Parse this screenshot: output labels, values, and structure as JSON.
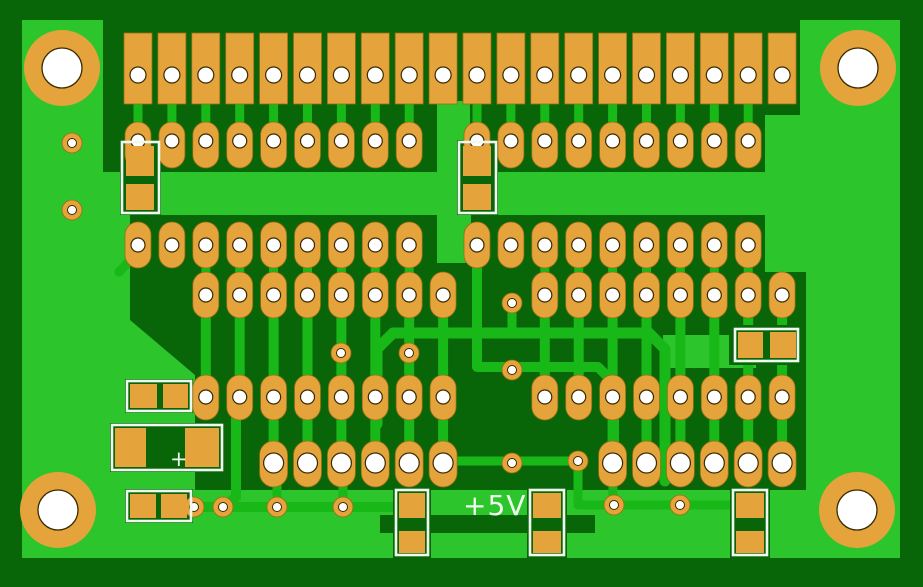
{
  "app": {
    "title": "PCB copper layer view"
  },
  "labels": {
    "voltage": {
      "text": "+5V",
      "x": 463,
      "y": 492,
      "size": 28
    },
    "cap_polarity": {
      "text": "+",
      "x": 170,
      "y": 449,
      "size": 21
    }
  },
  "colors": {
    "margin_dark": "#086609",
    "copper_pour": "#2cc52c",
    "trace": "#18b818",
    "pad": "#e4a33b",
    "pad_edge": "#9c6d12",
    "hole": "#ffffff",
    "hole_edge": "#3a2a00",
    "silkscreen": "#f0f9ef"
  },
  "pcb": {
    "canvas": {
      "w": 923,
      "h": 587
    },
    "board": {
      "x": 22,
      "y": 20,
      "w": 878,
      "h": 538
    },
    "grid": {
      "x0": 138,
      "pitch": 33.9
    },
    "etched_regions": [
      {
        "type": "rect",
        "x": 103,
        "y": 20,
        "w": 697,
        "h": 95
      },
      {
        "type": "rect",
        "x": 103,
        "y": 115,
        "w": 662,
        "h": 57
      },
      {
        "type": "poly",
        "pts": [
          [
            130,
            215
          ],
          [
            765,
            215
          ],
          [
            765,
            490
          ],
          [
            195,
            490
          ],
          [
            195,
            375
          ],
          [
            130,
            320
          ]
        ]
      },
      {
        "type": "rect",
        "x": 764,
        "y": 272,
        "w": 42,
        "h": 218
      }
    ],
    "copper_channels": [
      {
        "x": 437,
        "y": 101,
        "w": 33,
        "h": 71
      },
      {
        "x": 437,
        "y": 215,
        "w": 34,
        "h": 48
      },
      {
        "x": 663,
        "y": 335,
        "w": 93,
        "h": 33
      }
    ],
    "stub_groups": [
      {
        "cols": [
          0,
          1,
          2,
          3,
          4,
          5,
          6,
          7,
          8,
          10,
          11,
          12,
          13,
          14,
          15,
          16,
          17,
          18
        ],
        "y": 99,
        "h": 27,
        "w": 9
      },
      {
        "cols": [
          2,
          3,
          4,
          5,
          6,
          7,
          8,
          12,
          13,
          14,
          15,
          16,
          17,
          18
        ],
        "y": 262,
        "h": 14,
        "w": 9
      },
      {
        "cols": [
          2,
          3,
          4,
          5,
          6,
          7,
          8,
          9,
          12,
          13,
          14,
          15,
          16,
          17,
          18,
          19
        ],
        "y": 314,
        "h": 64,
        "w": 10
      },
      {
        "cols": [
          4,
          5,
          6,
          7,
          8,
          9,
          14,
          15,
          16,
          17,
          18,
          19
        ],
        "y": 416,
        "h": 28,
        "w": 10
      }
    ],
    "traces": [
      {
        "d": "M 377 424 L 377 349 L 393 333 L 649 333 L 665 349 L 665 481",
        "w": 11
      },
      {
        "d": "M 477 258 L 477 367 L 598 367 L 614 383 L 614 446",
        "w": 10
      },
      {
        "d": "M 613 483 L 613 503",
        "w": 9
      },
      {
        "d": "M 512 305 L 512 333",
        "w": 9
      },
      {
        "d": "M 434 461 L 575 461",
        "w": 9
      },
      {
        "d": "M 578 463 L 578 505 L 733 505",
        "w": 9
      },
      {
        "d": "M 194 507 L 397 507",
        "w": 10
      },
      {
        "d": "M 140 250 L 119 272",
        "w": 9
      },
      {
        "d": "M 236 418 L 236 497 L 226 505",
        "w": 10
      },
      {
        "d": "M 277 480 L 277 503",
        "w": 9
      },
      {
        "d": "M 343 480 L 343 503",
        "w": 9
      }
    ],
    "overlay_dark": [
      {
        "x": 380,
        "y": 515,
        "w": 215,
        "h": 18
      }
    ],
    "pad_rows": [
      {
        "name": "connector-row-1",
        "shape": "rect",
        "cols": [
          0,
          1,
          2,
          3,
          4,
          5,
          6,
          7,
          8,
          9,
          10,
          11,
          12,
          13,
          14,
          15,
          16,
          17,
          18,
          19
        ],
        "y": 33,
        "h": 71,
        "w": 28,
        "holeY": 75,
        "holeR": 8
      },
      {
        "name": "header-row-2",
        "shape": "stadium",
        "cols": [
          0,
          1,
          2,
          3,
          4,
          5,
          6,
          7,
          8,
          10,
          11,
          12,
          13,
          14,
          15,
          16,
          17,
          18
        ],
        "y": 122,
        "h": 46,
        "w": 26,
        "holeY": 141,
        "holeR": 7
      },
      {
        "name": "header-row-3",
        "shape": "stadium",
        "cols": [
          0,
          1,
          2,
          3,
          4,
          5,
          6,
          7,
          8,
          10,
          11,
          12,
          13,
          14,
          15,
          16,
          17,
          18
        ],
        "y": 222,
        "h": 46,
        "w": 26,
        "holeY": 245,
        "holeR": 7
      },
      {
        "name": "header-row-4",
        "shape": "stadium",
        "cols": [
          2,
          3,
          4,
          5,
          6,
          7,
          8,
          9,
          12,
          13,
          14,
          15,
          16,
          17,
          18,
          19
        ],
        "y": 272,
        "h": 46,
        "w": 26,
        "holeY": 295,
        "holeR": 7
      },
      {
        "name": "header-row-5",
        "shape": "stadium",
        "cols": [
          2,
          3,
          4,
          5,
          6,
          7,
          8,
          9,
          12,
          13,
          14,
          15,
          16,
          17,
          18,
          19
        ],
        "y": 375,
        "h": 45,
        "w": 26,
        "holeY": 397,
        "holeR": 7
      },
      {
        "name": "power-row-6",
        "shape": "stadium",
        "cols": [
          4,
          5,
          6,
          7,
          8,
          9,
          14,
          15,
          16,
          17,
          18,
          19
        ],
        "y": 441,
        "h": 46,
        "w": 28,
        "holeY": 463,
        "holeR": 10
      }
    ],
    "via_pads": {
      "r": 10,
      "holeR": 4.5,
      "points": [
        [
          72,
          143
        ],
        [
          72,
          210
        ],
        [
          341,
          353
        ],
        [
          409,
          353
        ],
        [
          512,
          303
        ],
        [
          512,
          370
        ],
        [
          512,
          463
        ],
        [
          578,
          461
        ],
        [
          614,
          505
        ],
        [
          680,
          505
        ],
        [
          194,
          507
        ],
        [
          223,
          507
        ],
        [
          277,
          507
        ],
        [
          343,
          507
        ]
      ]
    },
    "mounting_holes": {
      "rOuter": 38,
      "rHole": 20,
      "points": [
        [
          62,
          68
        ],
        [
          858,
          68
        ],
        [
          58,
          510
        ],
        [
          857,
          510
        ]
      ]
    },
    "smd_components": [
      {
        "name": "smd-resistor-vertical-left",
        "outline": [
          122,
          142,
          37,
          71
        ],
        "dark": [
          120,
          140,
          41,
          75
        ],
        "pads": [
          [
            126,
            146,
            28,
            30
          ],
          [
            126,
            184,
            28,
            26
          ]
        ]
      },
      {
        "name": "smd-resistor-vertical-mid",
        "outline": [
          459,
          142,
          37,
          71
        ],
        "dark": [
          457,
          140,
          41,
          75
        ],
        "pads": [
          [
            463,
            146,
            28,
            30
          ],
          [
            463,
            184,
            28,
            26
          ]
        ]
      },
      {
        "name": "smd-resistor-horizontal-left",
        "outline": [
          127,
          381,
          64,
          30
        ],
        "dark": [
          125,
          379,
          68,
          34
        ],
        "pads": [
          [
            130,
            384,
            27,
            24
          ],
          [
            163,
            384,
            25,
            24
          ]
        ]
      },
      {
        "name": "smd-capacitor-polarized",
        "outline": [
          112,
          425,
          110,
          45
        ],
        "dark": [
          110,
          423,
          114,
          49
        ],
        "pads": [
          [
            115,
            428,
            31,
            39
          ],
          [
            185,
            428,
            34,
            39
          ]
        ]
      },
      {
        "name": "smd-resistor-lower-left",
        "outline": [
          127,
          491,
          64,
          30
        ],
        "dark": [
          125,
          489,
          68,
          34
        ],
        "pads": [
          [
            130,
            494,
            26,
            24
          ],
          [
            161,
            494,
            26,
            24
          ]
        ]
      },
      {
        "name": "smd-resistor-right",
        "outline": [
          735,
          329,
          63,
          32
        ],
        "dark": [
          729,
          325,
          75,
          40
        ],
        "pads": [
          [
            738,
            332,
            25,
            26
          ],
          [
            770,
            332,
            26,
            26
          ]
        ]
      },
      {
        "name": "smd-bottom-1",
        "outline": [
          396,
          490,
          32,
          65
        ],
        "dark": [
          393,
          487,
          38,
          71
        ],
        "pads": [
          [
            399,
            493,
            26,
            25
          ],
          [
            399,
            531,
            26,
            22
          ]
        ]
      },
      {
        "name": "smd-bottom-2",
        "outline": [
          530,
          490,
          34,
          65
        ],
        "dark": [
          527,
          487,
          40,
          71
        ],
        "pads": [
          [
            533,
            493,
            28,
            25
          ],
          [
            533,
            531,
            28,
            22
          ]
        ]
      },
      {
        "name": "smd-bottom-3",
        "outline": [
          733,
          490,
          34,
          65
        ],
        "dark": [
          730,
          487,
          40,
          71
        ],
        "pads": [
          [
            736,
            493,
            28,
            25
          ],
          [
            736,
            531,
            28,
            22
          ]
        ]
      }
    ]
  }
}
